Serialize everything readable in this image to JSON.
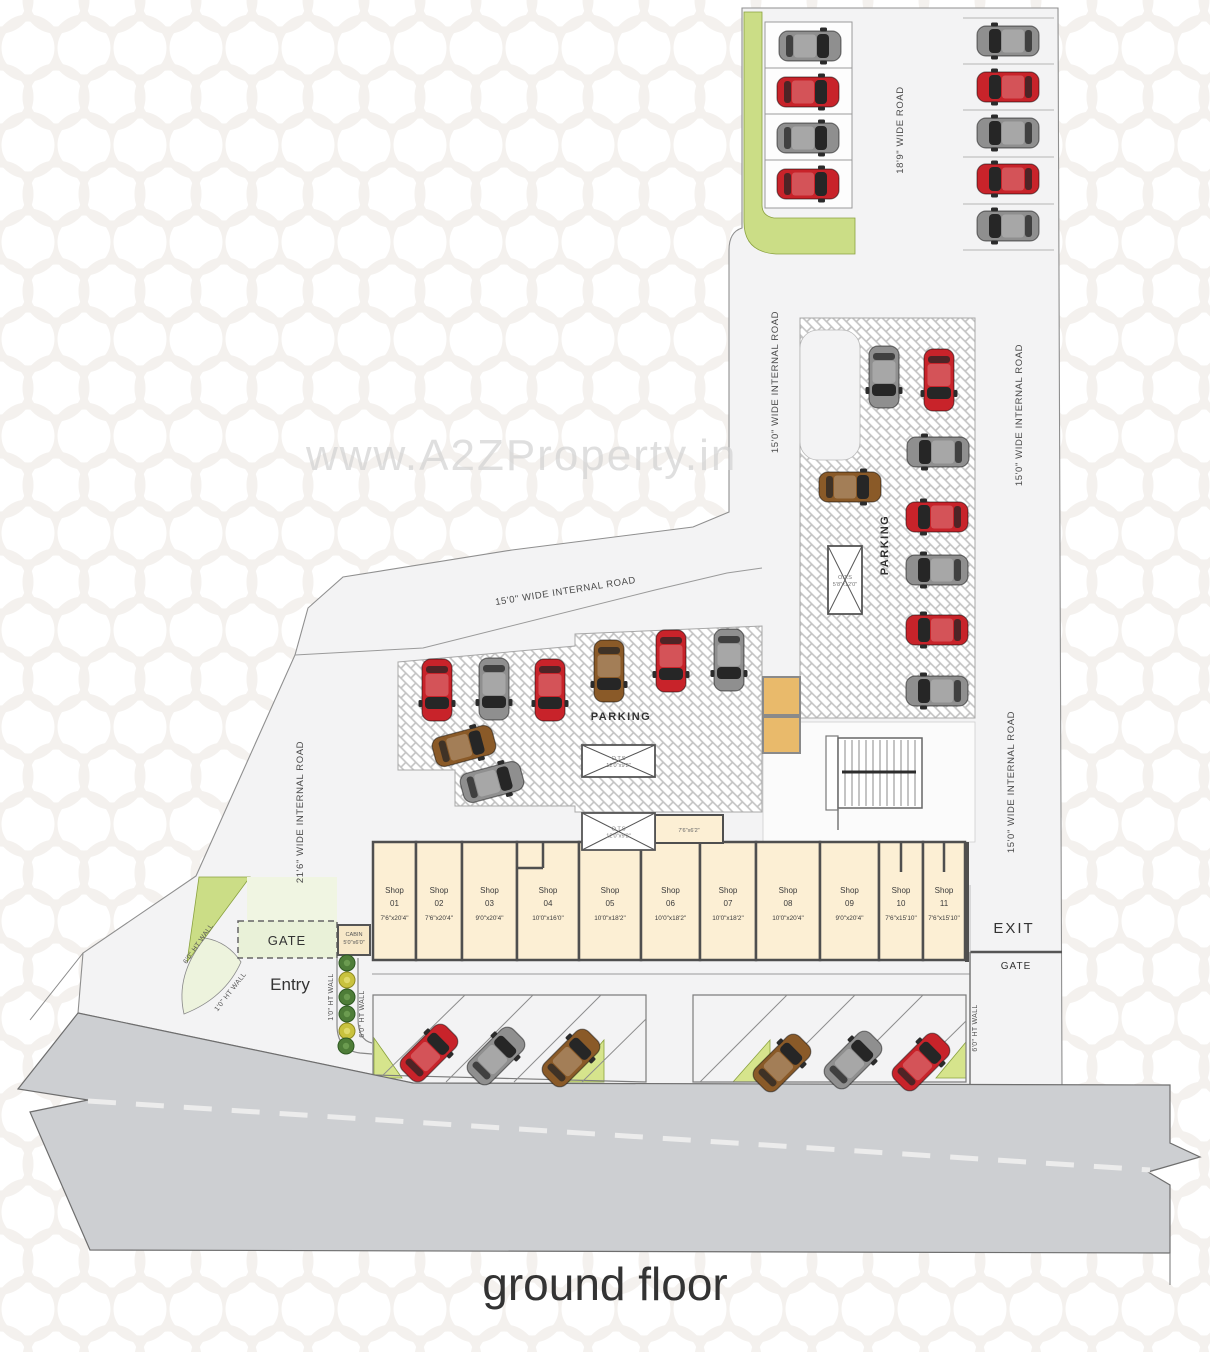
{
  "title": {
    "text": "ground floor"
  },
  "watermark": {
    "text": "www.A2ZProperty.in"
  },
  "colors": {
    "road": "#f3f3f4",
    "bottom_road": "#cdcfd2",
    "green": "#cbdd86",
    "green_light": "#edf3dd",
    "gate_fill": "#e9f1d8",
    "shop_fill": "#fcefd4",
    "tan": "#e9ba6b",
    "wall": "#4f4f4f",
    "car_red": "#c8232a",
    "car_gray": "#8f8f8f",
    "car_brown": "#8a5a28"
  },
  "area_labels": {
    "parking_center": "PARKING",
    "parking_right": "PARKING",
    "entry": "Entry",
    "exit": "EXIT",
    "gate_entry": "GATE",
    "gate_exit": "GATE",
    "cabin_name": "CABIN",
    "cabin_dims": "5'0\"x6'0\"",
    "room_dims": "7'6\"x6'2\""
  },
  "road_labels": [
    {
      "text": "18'9\" WIDE ROAD",
      "x": 903,
      "y": 130,
      "rot": -90
    },
    {
      "text": "15'0\" WIDE INTERNAL ROAD",
      "x": 1022,
      "y": 415,
      "rot": -90
    },
    {
      "text": "15'0\" WIDE INTERNAL ROAD",
      "x": 1014,
      "y": 782,
      "rot": -90
    },
    {
      "text": "15'0\" WIDE INTERNAL ROAD",
      "x": 778,
      "y": 382,
      "rot": -90
    },
    {
      "text": "15'0\" WIDE INTERNAL ROAD",
      "x": 566,
      "y": 594,
      "rot": -9
    },
    {
      "text": "21'6\" WIDE INTERNAL ROAD",
      "x": 303,
      "y": 812,
      "rot": -90
    }
  ],
  "wall_labels": [
    {
      "text": "6'0\" HT WALL",
      "x": 200,
      "y": 945,
      "rot": -55
    },
    {
      "text": "1'0\" HT WALL",
      "x": 232,
      "y": 993,
      "rot": -52
    },
    {
      "text": "1'0\" HT WALL",
      "x": 333,
      "y": 997,
      "rot": -90
    },
    {
      "text": "6'0\" HT WALL",
      "x": 364,
      "y": 1014,
      "rot": -90
    },
    {
      "text": "6'0\" HT WALL",
      "x": 977,
      "y": 1028,
      "rot": -90
    }
  ],
  "ots_boxes": [
    {
      "label": "O.T.S",
      "dims": "12'0\"x9'2\"",
      "x": 582,
      "y": 745,
      "w": 73,
      "h": 32
    },
    {
      "label": "O.T.S",
      "dims": "12'0\"x9'2\"",
      "x": 582,
      "y": 813,
      "w": 73,
      "h": 37
    },
    {
      "label": "O.T.S",
      "dims": "5'8\"x12'0\"",
      "x": 828,
      "y": 546,
      "w": 34,
      "h": 68
    }
  ],
  "shops": {
    "label": "Shop",
    "bounds": [
      373,
      416,
      462,
      517,
      579,
      641,
      700,
      756,
      820,
      879,
      923,
      965
    ],
    "items": [
      {
        "num": "01",
        "dims": "7'6\"x20'4\""
      },
      {
        "num": "02",
        "dims": "7'6\"x20'4\""
      },
      {
        "num": "03",
        "dims": "9'0\"x20'4\""
      },
      {
        "num": "04",
        "dims": "10'0\"x16'0\""
      },
      {
        "num": "05",
        "dims": "10'0\"x18'2\""
      },
      {
        "num": "06",
        "dims": "10'0\"x18'2\""
      },
      {
        "num": "07",
        "dims": "10'0\"x18'2\""
      },
      {
        "num": "08",
        "dims": "10'0\"x20'4\""
      },
      {
        "num": "09",
        "dims": "9'0\"x20'4\""
      },
      {
        "num": "10",
        "dims": "7'6\"x15'10\""
      },
      {
        "num": "11",
        "dims": "7'6\"x15'10\""
      }
    ]
  },
  "cars": [
    {
      "x": 810,
      "y": 46,
      "rot": 90,
      "color": "gray"
    },
    {
      "x": 808,
      "y": 92,
      "rot": 90,
      "color": "red"
    },
    {
      "x": 808,
      "y": 138,
      "rot": 90,
      "color": "gray"
    },
    {
      "x": 808,
      "y": 184,
      "rot": 90,
      "color": "red"
    },
    {
      "x": 1008,
      "y": 41,
      "rot": -90,
      "color": "gray"
    },
    {
      "x": 1008,
      "y": 87,
      "rot": -90,
      "color": "red"
    },
    {
      "x": 1008,
      "y": 133,
      "rot": -90,
      "color": "gray"
    },
    {
      "x": 1008,
      "y": 179,
      "rot": -90,
      "color": "red"
    },
    {
      "x": 1008,
      "y": 226,
      "rot": -90,
      "color": "gray"
    },
    {
      "x": 884,
      "y": 377,
      "rot": 180,
      "color": "gray"
    },
    {
      "x": 939,
      "y": 380,
      "rot": 180,
      "color": "red"
    },
    {
      "x": 938,
      "y": 452,
      "rot": -90,
      "color": "gray"
    },
    {
      "x": 850,
      "y": 487,
      "rot": 90,
      "color": "brown"
    },
    {
      "x": 937,
      "y": 517,
      "rot": -90,
      "color": "red"
    },
    {
      "x": 937,
      "y": 570,
      "rot": -90,
      "color": "gray"
    },
    {
      "x": 937,
      "y": 630,
      "rot": -90,
      "color": "red"
    },
    {
      "x": 937,
      "y": 691,
      "rot": -90,
      "color": "gray"
    },
    {
      "x": 437,
      "y": 690,
      "rot": 180,
      "color": "red"
    },
    {
      "x": 494,
      "y": 689,
      "rot": 180,
      "color": "gray"
    },
    {
      "x": 550,
      "y": 690,
      "rot": 180,
      "color": "red"
    },
    {
      "x": 609,
      "y": 671,
      "rot": 180,
      "color": "brown"
    },
    {
      "x": 671,
      "y": 661,
      "rot": 180,
      "color": "red"
    },
    {
      "x": 729,
      "y": 660,
      "rot": 180,
      "color": "gray"
    },
    {
      "x": 464,
      "y": 746,
      "rot": 75,
      "color": "brown"
    },
    {
      "x": 492,
      "y": 782,
      "rot": 75,
      "color": "gray"
    },
    {
      "x": 429,
      "y": 1053,
      "rot": 45,
      "color": "red"
    },
    {
      "x": 496,
      "y": 1056,
      "rot": 45,
      "color": "gray"
    },
    {
      "x": 571,
      "y": 1058,
      "rot": 45,
      "color": "brown"
    },
    {
      "x": 782,
      "y": 1063,
      "rot": 45,
      "color": "brown"
    },
    {
      "x": 853,
      "y": 1060,
      "rot": 45,
      "color": "gray"
    },
    {
      "x": 921,
      "y": 1062,
      "rot": 45,
      "color": "red"
    }
  ],
  "trees": [
    {
      "x": 347,
      "y": 963,
      "v": "dark"
    },
    {
      "x": 347,
      "y": 980,
      "v": "yellow"
    },
    {
      "x": 347,
      "y": 997,
      "v": "dark"
    },
    {
      "x": 347,
      "y": 1014,
      "v": "dark"
    },
    {
      "x": 347,
      "y": 1031,
      "v": "yellow"
    },
    {
      "x": 346,
      "y": 1046,
      "v": "dark"
    }
  ]
}
